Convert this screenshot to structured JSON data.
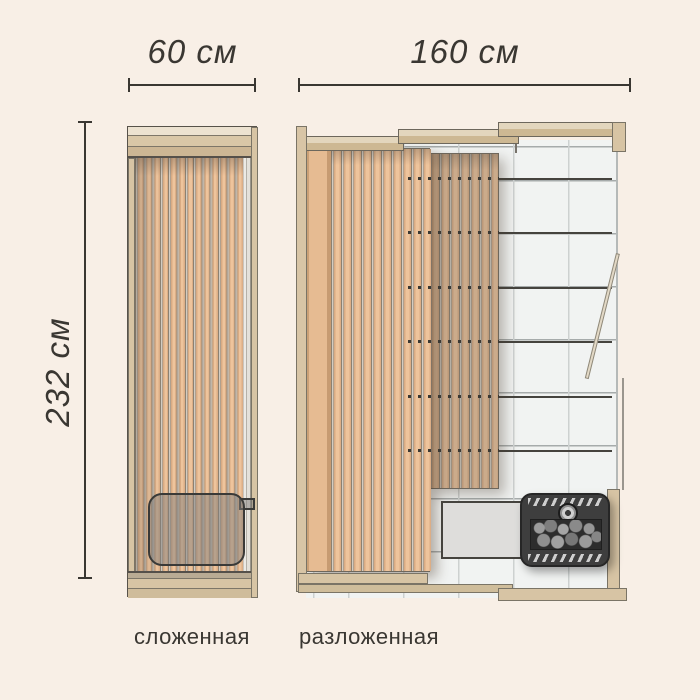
{
  "title": "Схема складной сауны: размеры в сложенном и разложенном виде",
  "dimensions": {
    "folded_width": "60 см",
    "unfolded_width": "160 см",
    "height": "232 см"
  },
  "captions": {
    "folded": "сложенная",
    "unfolded": "разложенная"
  },
  "icons": {
    "heater": "sauna-stove-with-stones-icon",
    "knob": "stove-control-knob-icon"
  },
  "palette": {
    "bg": "#f8efe6",
    "ink": "#3a3732",
    "outline": "#57524a",
    "wood": "#d7c4a4",
    "wood_light": "#e9dfcd",
    "wood_mid": "#d9c7a7",
    "wood_dark": "#ccb694",
    "slat_peach": "#eec49c",
    "slat_edge": "#d9ab83",
    "tile_bg": "#f1f3f2",
    "grout_v": "#cdd1d0",
    "grout_h": "#a6abab",
    "railline": "#45433e",
    "bench": "#dedddb",
    "heater": "#3e3e3e"
  }
}
